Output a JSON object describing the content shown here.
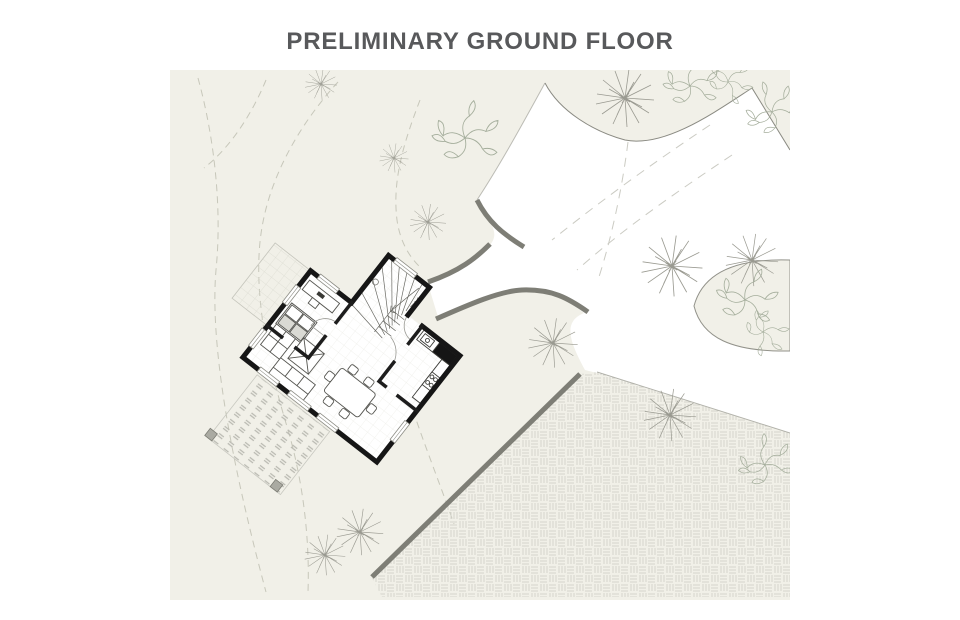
{
  "header": {
    "title": "PRELIMINARY GROUND FLOOR"
  },
  "canvas": {
    "width": 960,
    "height": 620,
    "background": "#ffffff"
  },
  "site": {
    "background": "#f1f0e8",
    "driveway_fill": "#ffffff",
    "boundary_line": "#8a8a82",
    "retaining_wall": "#7e7e76",
    "house_wall": "#161616",
    "interior_wall": "#1d1d1d",
    "furniture_line": "#555550",
    "hatch_line": "#d5d5cd",
    "deck_line": "#b9b9b1",
    "tile_line": "#dcdcd2",
    "contour_line": "#c7c7ba",
    "tree_line": "#9a9a91",
    "foliage_line": "#a4ad9b",
    "window_line": "#8d8d85",
    "door_arc": "#9a9a94",
    "post_fill": "#aaaaa2"
  }
}
